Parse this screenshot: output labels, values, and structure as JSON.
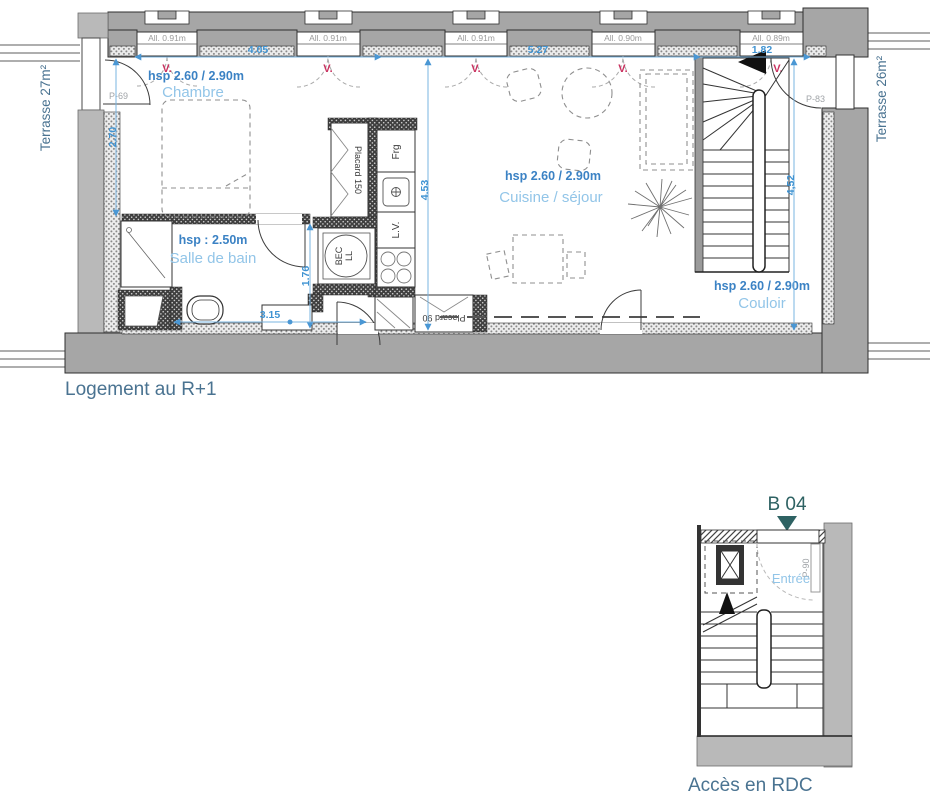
{
  "titles": {
    "main_plan": "Logement au R+1",
    "access_plan": "Accès en RDC",
    "unit_label": "B 04"
  },
  "terraces": {
    "left": "Terrasse 27m²",
    "right": "Terrasse 26m²"
  },
  "rooms": {
    "chambre": {
      "hsp": "hsp 2.60 / 2.90m",
      "name": "Chambre"
    },
    "salle_de_bain": {
      "hsp": "hsp : 2.50m",
      "name": "Salle de bain"
    },
    "cuisine_sejour": {
      "hsp": "hsp 2.60 / 2.90m",
      "name": "Cuisine / séjour"
    },
    "couloir": {
      "hsp": "hsp 2.60 / 2.90m",
      "name": "Couloir"
    },
    "entree": {
      "name": "Entrée"
    }
  },
  "dimensions": {
    "w_chambre": "4.05",
    "w_sejour": "5.27",
    "w_stair": "1.82",
    "h_chambre": "2.70",
    "h_kitchen": "4.53",
    "h_couloir": "4,52",
    "w_bath": "3.15",
    "h_bath": "1.76"
  },
  "windows": [
    {
      "label": "All. 0.91m",
      "vent": "V."
    },
    {
      "label": "All. 0.91m",
      "vent": "V."
    },
    {
      "label": "All. 0.91m",
      "vent": "V."
    },
    {
      "label": "All. 0.90m",
      "vent": "V."
    },
    {
      "label": "All. 0.89m",
      "vent": "V."
    }
  ],
  "doors": {
    "p69": "P-69",
    "p83": "P-83",
    "p90": "P-90"
  },
  "fixtures": {
    "fridge": "Frg",
    "dishwasher": "L.V.",
    "washer_line1": "BEC",
    "washer_line2": "LL",
    "closet_large": "Placard 150",
    "closet_small": "Placard 90"
  },
  "colors": {
    "dim_blue": "#7ab4e0",
    "dim_text_blue": "#3f93d2",
    "hsp_blue": "#3b82c4",
    "room_blue": "#92c5e8",
    "vent_red": "#c9315f",
    "title_slate": "#4a7391",
    "unit_teal": "#2e6263",
    "wall_gray": "#a6a6a6"
  }
}
